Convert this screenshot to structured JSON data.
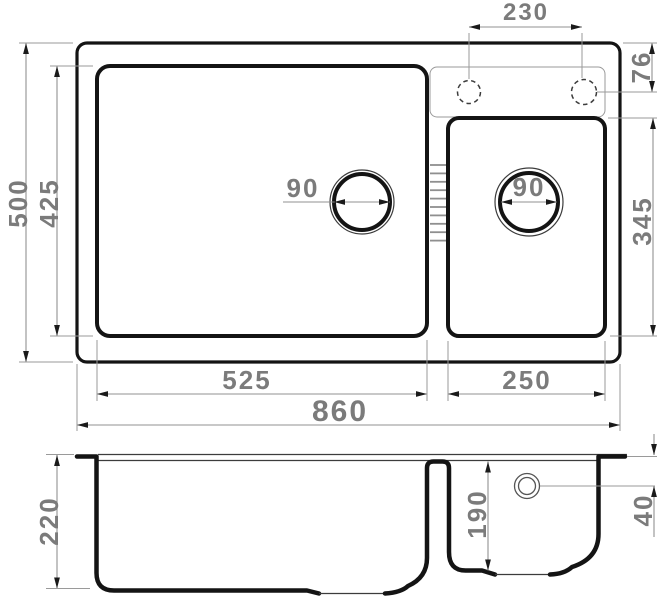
{
  "drawing": {
    "top_view": {
      "labels": {
        "faucet_hole_spacing": "230",
        "faucet_hole_offset": "76",
        "main_drain_diameter": "90",
        "small_drain_diameter": "90",
        "small_bowl_length": "345",
        "overall_depth": "500",
        "main_bowl_depth": "425",
        "main_bowl_width": "525",
        "small_bowl_width": "250",
        "overall_width": "860"
      }
    },
    "front_view": {
      "labels": {
        "main_bowl_height": "220",
        "small_bowl_height": "190",
        "drain_center_offset": "40"
      }
    },
    "colors": {
      "outline": "#141414",
      "thin_line": "#3c3c3c",
      "dimension_line": "#929292",
      "label_text": "#7b7b7b",
      "background": "#ffffff"
    }
  }
}
